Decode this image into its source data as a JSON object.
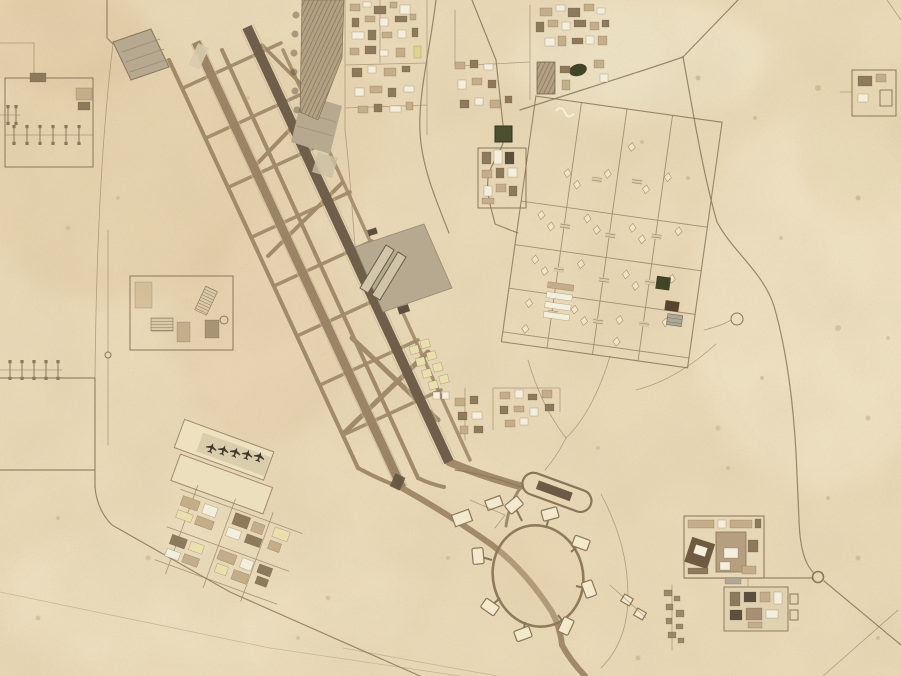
{
  "scene": {
    "type": "satellite-aerial-photograph",
    "description": "Satellite view of a desert air base: two parallel runways running northwest to southeast with a ladder of connecting taxiways, large aircraft aprons and hangars, a dense support-facility zone to the north and east, a gridded tent cantonment, perimeter roads, walled compounds in the southeast, an antenna-farm compound in the west, and a circular dispersal loop taxiway with parking pads in the south",
    "terrain": "sand desert",
    "visible_text": ""
  },
  "colors": {
    "sand": "#ecdcba",
    "sandLight": "#f3e9cd",
    "sandPink": "#e3cba6",
    "road": "#8a775a",
    "taxiway": "#a18a69",
    "connector": "#a08a6a",
    "runwayWest": "#9b8465",
    "runwayEast": "#6e5e4a",
    "runwayEdge": "#c9b892",
    "runwayCenter": "#38claimed2f26",
    "apron": "#b6a98f",
    "apronLight": "#cbbfa4",
    "bldgTan": "#c4ad89",
    "bldgBrown": "#8d7a5c",
    "bldgWhite": "#f4eedc",
    "bldgDark": "#5c4f3d",
    "bldgYellow": "#ddd490",
    "bldgPaleYellow": "#eae0ad",
    "greenPatch": "#4b5130",
    "darkPatch": "#3f4526",
    "grayRoof": "#b0a896",
    "tent": "#f0e6c6",
    "tentEdge": "#a89070",
    "aircraft": "#3f382c",
    "dot": "#b09a76"
  },
  "regions": {
    "runway_west": "western runway",
    "runway_east": "eastern runway with dark centerline",
    "taxiway_network": "parallel taxiways and diagonal connectors",
    "north_apron": "paved apron northeast of runways",
    "central_apron": "main apron with twin hangars",
    "diamond_apron": "diamond-shaped pad at northwest runway end",
    "dispersal_loop": "circular dispersal taxiway with parking pads",
    "thermometer_pad": "elongated loop pad northeast of dispersal circle",
    "industrial_zone": "dense facility blocks at top center",
    "cantonment_grid": "gridded tent camp east of the airfield",
    "antenna_compound": "walled antenna-farm compound on the west edge",
    "southwest_compound": "barracks compound and aircraft apron southwest of runway end",
    "southeast_compounds": "two walled compounds near the southeast perimeter",
    "perimeter_road": "curving perimeter road on the east side"
  }
}
